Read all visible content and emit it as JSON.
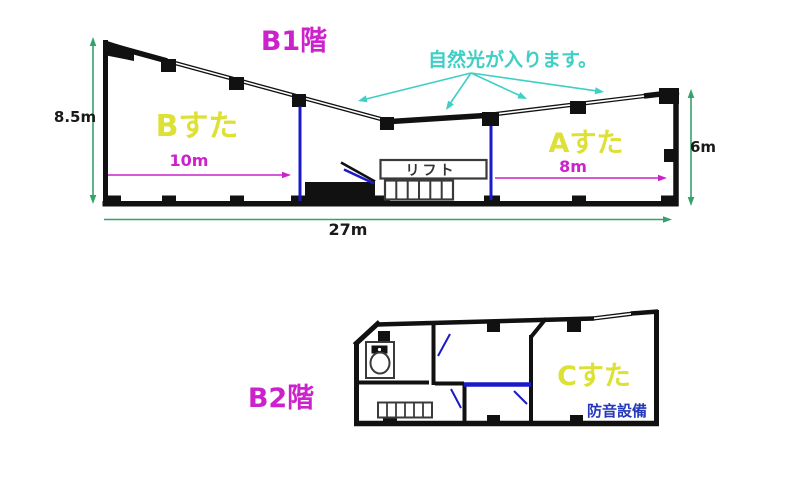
{
  "palette": {
    "title_magenta": "#cc22cc",
    "room_yellow": "#dde135",
    "note_cyan": "#3ecfc5",
    "dimension_green": "#35a26b",
    "partition_blue": "#1a1ac8",
    "soundproof_blue": "#2438be",
    "wall_black": "#111111"
  },
  "b1": {
    "title": "B1階",
    "natural_light_note": "自然光が入ります。",
    "studio_b": {
      "label": "Bすた",
      "width": "10m"
    },
    "studio_a": {
      "label": "Aすた",
      "width": "8m"
    },
    "lift_label": "リフト",
    "dimensions": {
      "left_height": "8.5m",
      "right_height": "6m",
      "total_width": "27m"
    }
  },
  "b2": {
    "title": "B2階",
    "studio_c": {
      "label": "Cすた"
    },
    "soundproof_note": "防音設備"
  }
}
